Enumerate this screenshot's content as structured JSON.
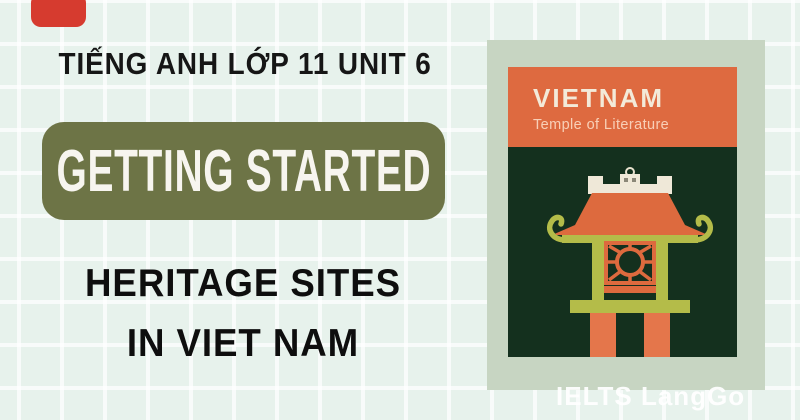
{
  "banner": {
    "unit_heading": "TIẾNG ANH LỚP 11 UNIT 6",
    "section_badge": "GETTING STARTED",
    "title_line1": "HERITAGE SITES",
    "title_line2": "IN VIET NAM"
  },
  "stamp": {
    "country": "VIETNAM",
    "site": "Temple of Literature"
  },
  "brand": {
    "logo": "IELTS LangGo"
  },
  "colors": {
    "background_mint": "#e7f2ec",
    "accent_red": "#d63b2f",
    "badge_olive": "#6d7446",
    "stamp_sage": "#c7d5c2",
    "card_header_orange": "#de6a40",
    "card_body_green": "#14301e",
    "temple_orange": "#dd6a3e",
    "temple_leg_orange": "#e4764b",
    "temple_olive": "#b4bc49",
    "temple_cream": "#efe8d8",
    "text_dark": "#141414",
    "text_light": "#ffffff"
  }
}
